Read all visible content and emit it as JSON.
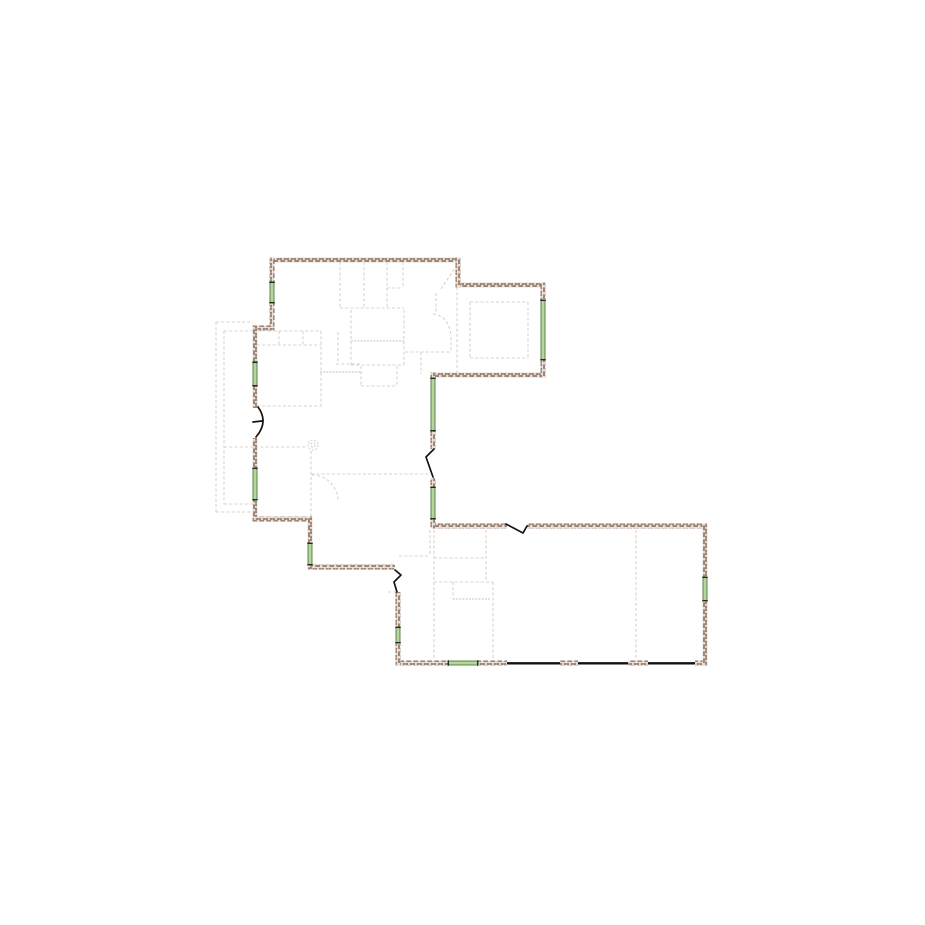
{
  "canvas": {
    "width": 925,
    "height": 925,
    "background": "#ffffff"
  },
  "palette": {
    "wall_brick_dark": "#8d7060",
    "wall_brick_light": "#e7dfd6",
    "window_fill": "#b7d59e",
    "window_edge": "#4d7c38",
    "window_cap": "#1a1a1a",
    "door_stroke": "#141414",
    "garage_door_stroke": "#111111",
    "reference_dash": "#d8d3cc"
  },
  "walls": {
    "thickness": 5,
    "horizontal": [
      [
        270.0,
        257.5,
        190.0,
        5
      ],
      [
        455.5,
        282.5,
        90.0,
        5
      ],
      [
        430.5,
        372.5,
        115.0,
        5
      ],
      [
        430.5,
        523.5,
        76.5,
        5
      ],
      [
        527.0,
        523.5,
        180.5,
        5
      ],
      [
        395.5,
        660.5,
        52.5,
        5
      ],
      [
        478.0,
        660.5,
        29.0,
        5
      ],
      [
        560.0,
        660.5,
        18.0,
        5
      ],
      [
        628.0,
        660.5,
        20.0,
        5
      ],
      [
        695.0,
        660.5,
        12.5,
        5
      ],
      [
        307.5,
        564.5,
        87.5,
        5
      ],
      [
        252.5,
        516.5,
        60.0,
        5
      ],
      [
        252.5,
        325.5,
        22.0,
        5
      ]
    ],
    "vertical": [
      [
        455.5,
        257.5,
        5,
        30.0
      ],
      [
        540.5,
        282.5,
        5,
        95.0
      ],
      [
        430.5,
        372.5,
        5,
        5.5
      ],
      [
        430.5,
        431.0,
        5,
        18.0
      ],
      [
        430.5,
        478.0,
        5,
        9.0
      ],
      [
        430.5,
        519.0,
        5,
        9.5
      ],
      [
        702.5,
        523.5,
        5,
        53.5
      ],
      [
        702.5,
        601.0,
        5,
        64.5
      ],
      [
        395.5,
        592.0,
        5,
        35.0
      ],
      [
        395.5,
        643.0,
        5,
        22.5
      ],
      [
        307.5,
        516.5,
        5,
        26.5
      ],
      [
        307.5,
        565.0,
        5,
        4.5
      ],
      [
        252.5,
        326.0,
        5,
        36.0
      ],
      [
        252.5,
        386.0,
        5,
        22.0
      ],
      [
        252.5,
        438.0,
        5,
        30.0
      ],
      [
        252.5,
        500.0,
        5,
        16.5
      ],
      [
        269.5,
        257.5,
        5,
        24.5
      ],
      [
        269.5,
        303.0,
        5,
        22.5
      ]
    ]
  },
  "windows": [
    {
      "orient": "v",
      "c": 272,
      "a": 282,
      "b": 303
    },
    {
      "orient": "v",
      "c": 255,
      "a": 362,
      "b": 386
    },
    {
      "orient": "v",
      "c": 255,
      "a": 468,
      "b": 500
    },
    {
      "orient": "v",
      "c": 310,
      "a": 543,
      "b": 565
    },
    {
      "orient": "v",
      "c": 433,
      "a": 378,
      "b": 431
    },
    {
      "orient": "v",
      "c": 433,
      "a": 487,
      "b": 519
    },
    {
      "orient": "v",
      "c": 543,
      "a": 300,
      "b": 360
    },
    {
      "orient": "v",
      "c": 705,
      "a": 577,
      "b": 601
    },
    {
      "orient": "v",
      "c": 398,
      "a": 627,
      "b": 643
    },
    {
      "orient": "h",
      "c": 663,
      "a": 448,
      "b": 478
    }
  ],
  "door_marks": [
    {
      "d": "M 258,407 Q 269,422 256,437 M 253,422 L 262,421"
    },
    {
      "d": "M 434,449 L 426,457 L 433,477"
    },
    {
      "d": "M 395,570 L 401,575 L 394,582 L 397,592"
    },
    {
      "d": "M 506,524 L 523,533 L 527,526"
    }
  ],
  "garage_door_lines": {
    "y": 663.3,
    "segments": [
      [
        507,
        560
      ],
      [
        578,
        628
      ],
      [
        648,
        695
      ]
    ]
  },
  "reference_lines": [
    [
      216,
      322,
      216,
      512
    ],
    [
      224,
      331,
      224,
      504
    ],
    [
      216,
      322,
      253,
      322
    ],
    [
      224,
      331,
      253,
      331
    ],
    [
      224,
      504,
      253,
      504
    ],
    [
      216,
      512,
      253,
      512
    ],
    [
      274,
      331,
      288,
      331
    ],
    [
      253,
      331,
      321,
      331
    ],
    [
      321,
      331,
      321,
      407
    ],
    [
      257,
      345,
      321,
      345
    ],
    [
      257,
      406,
      321,
      406
    ],
    [
      279,
      331,
      279,
      345
    ],
    [
      303,
      331,
      303,
      345
    ],
    [
      224,
      447,
      307,
      447
    ],
    [
      311,
      451,
      311,
      519
    ],
    [
      311,
      474,
      428,
      474
    ],
    [
      320,
      372,
      362,
      372,
      "d"
    ],
    [
      336,
      364,
      360,
      364
    ],
    [
      338,
      332,
      338,
      364
    ],
    [
      340,
      262,
      340,
      308
    ],
    [
      364,
      262,
      364,
      308
    ],
    [
      340,
      308,
      404,
      308
    ],
    [
      387,
      262,
      387,
      308
    ],
    [
      403,
      262,
      403,
      288
    ],
    [
      387,
      288,
      403,
      288
    ],
    [
      351,
      310,
      351,
      365
    ],
    [
      404,
      310,
      404,
      365
    ],
    [
      351,
      365,
      404,
      365
    ],
    [
      351,
      341,
      404,
      341,
      "d"
    ],
    [
      361,
      366,
      361,
      386
    ],
    [
      397,
      366,
      397,
      386
    ],
    [
      361,
      386,
      397,
      386
    ],
    [
      441,
      289,
      455,
      268
    ],
    [
      436,
      293,
      436,
      312
    ],
    [
      405,
      352,
      451,
      352
    ],
    [
      451,
      337,
      451,
      352
    ],
    [
      421,
      352,
      421,
      374
    ],
    [
      470,
      302,
      528,
      302
    ],
    [
      470,
      358,
      528,
      358
    ],
    [
      470,
      302,
      470,
      358
    ],
    [
      528,
      302,
      528,
      358
    ],
    [
      457,
      287,
      457,
      373
    ],
    [
      430,
      530,
      430,
      556
    ],
    [
      399,
      556,
      430,
      556
    ],
    [
      388,
      592,
      396,
      592
    ],
    [
      434,
      530,
      434,
      660
    ],
    [
      434,
      558,
      486,
      558
    ],
    [
      486,
      530,
      486,
      580
    ],
    [
      434,
      582,
      493,
      582
    ],
    [
      453,
      582,
      453,
      599
    ],
    [
      453,
      599,
      491,
      599,
      "d"
    ],
    [
      493,
      582,
      493,
      660
    ],
    [
      636,
      530,
      636,
      661
    ]
  ],
  "reference_arcs": [
    {
      "d": "M 312,475 A 26 26 0 0 1 338,501"
    },
    {
      "d": "M 433,314 Q 449,316 451,336"
    }
  ],
  "reference_circles": [
    {
      "cx": 313,
      "cy": 445,
      "r": 5.0
    },
    {
      "cx": 313,
      "cy": 445,
      "r": 2.2
    }
  ]
}
